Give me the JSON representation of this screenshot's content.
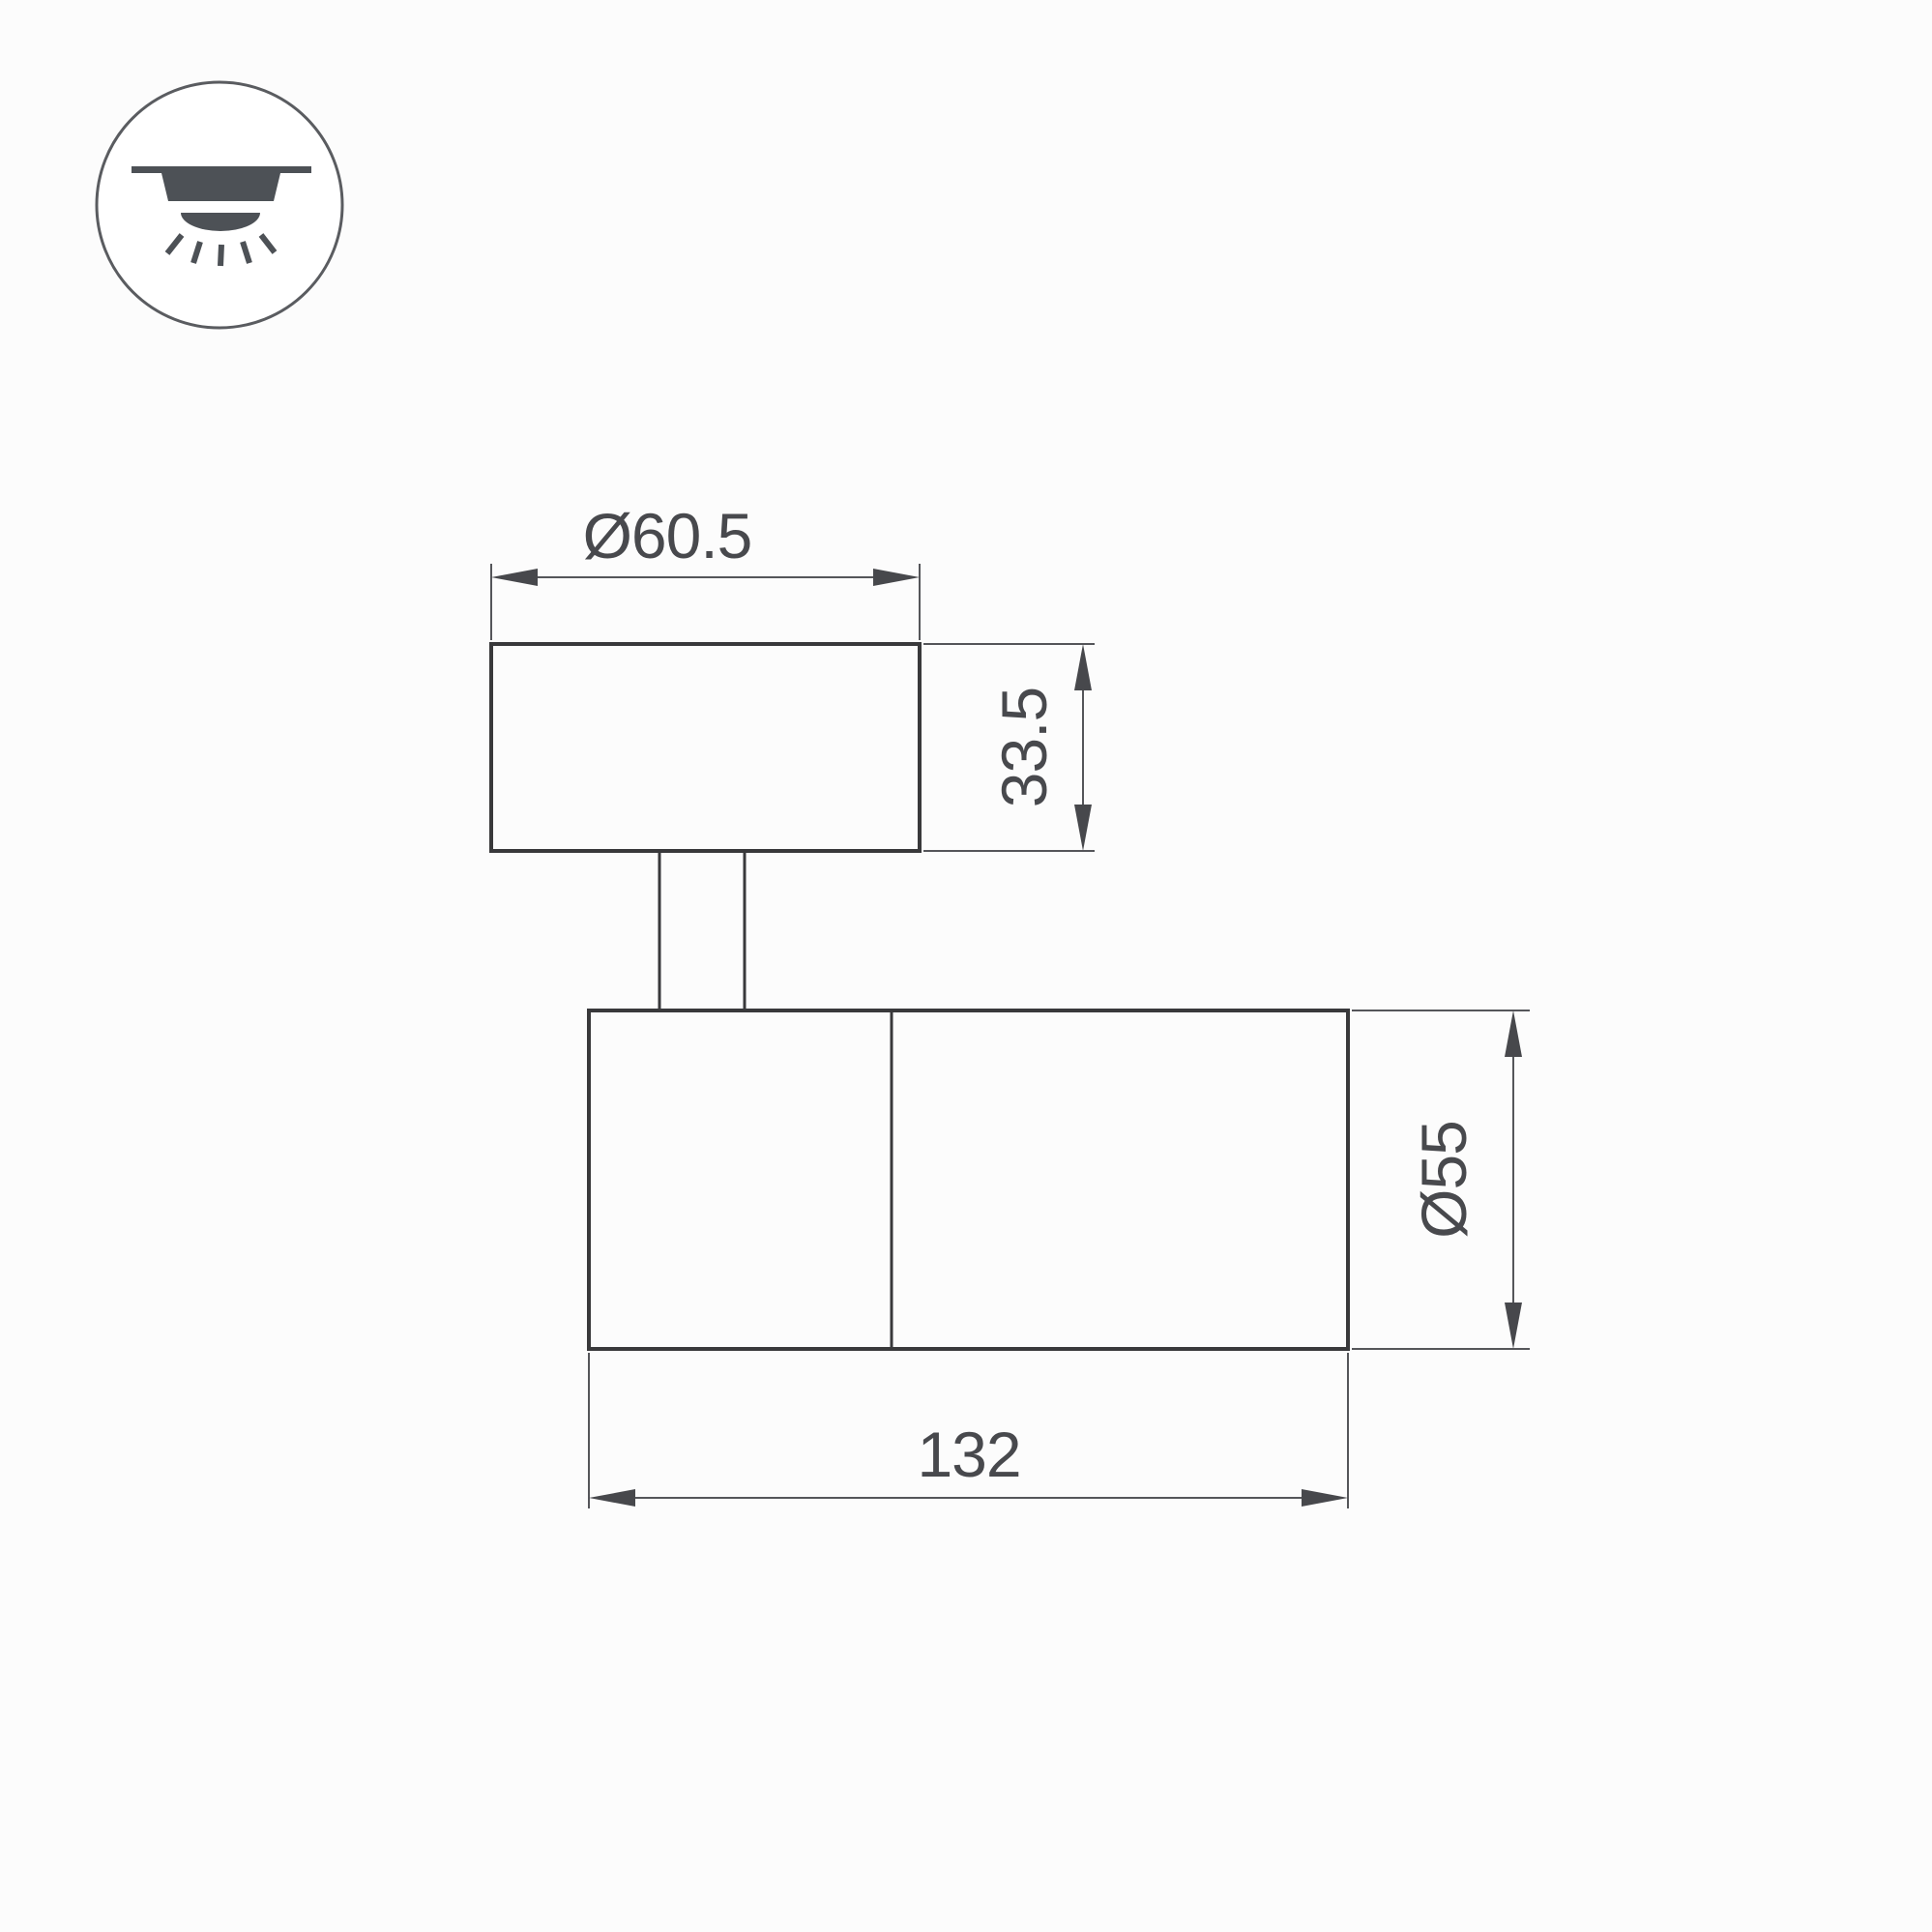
{
  "page": {
    "background": "#fcfcfc",
    "type": "technical-dimension-drawing",
    "subject": "surface-mounted-spot-light-fixture"
  },
  "icon": {
    "meaning": "ceiling-surface-mounted-light",
    "circle_stroke": "#5a5c60",
    "glyph_fill": "#4d5156"
  },
  "drawing": {
    "outline_color": "#39393b",
    "dimension_color": "#55565a",
    "arrow_color": "#47484c",
    "text_color": "#48494d",
    "dimensions": {
      "head_diameter": "Ø60.5",
      "head_height": "33.5",
      "body_diameter": "Ø55",
      "body_length": "132"
    }
  }
}
